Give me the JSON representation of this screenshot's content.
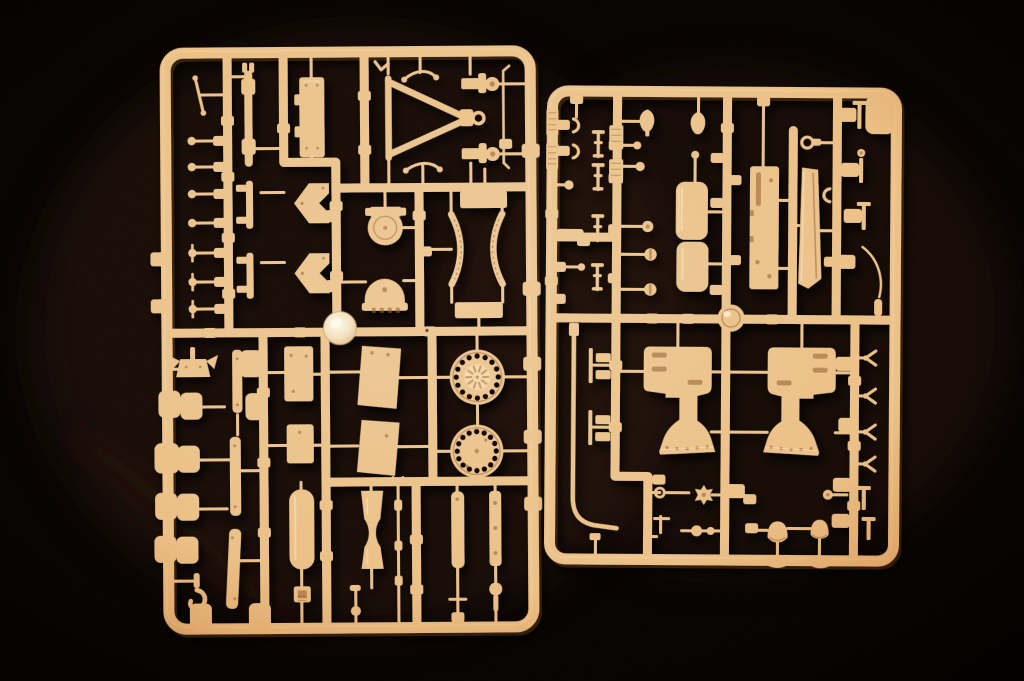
{
  "image": {
    "type": "photograph",
    "subject": "Two tan injection-molded plastic model-kit sprues (part frames) lying on a black background",
    "orientation": "landscape",
    "width_px": 1024,
    "height_px": 681
  },
  "colors": {
    "background": "#060302",
    "plastic": "#eecb98",
    "plastic_shadow": "#8a5526",
    "plastic_highlight": "#fdf0d6",
    "gate_blob_center": "#fffdf3",
    "gate_blob_edge": "#e3c493",
    "ambient_glow": "#2b190c",
    "vignette_orange": "#d8924e"
  },
  "sprues": [
    {
      "id": "left",
      "position": "left",
      "approx_bounds": {
        "x": 160,
        "y": 46,
        "w": 380,
        "h": 588
      },
      "notable_parts": [
        "column of seven small axle fittings",
        "thin tie rod",
        "coupling rod with sleeves",
        "two footed mounting bars",
        "equipment box with latches",
        "two chevron brackets",
        "round hatch with hinge tab",
        "dome cover with toothed flange",
        "towing A-frame with lunette ring",
        "two tie-rod linkages",
        "two capped stub-axle fittings",
        "long thin rod",
        "pair of curved serrated ribs",
        "two rectangular plates",
        "winged bracket",
        "ten rounded-square track pads",
        "tow hook",
        "three flat planks",
        "two riveted panels",
        "two trapezoidal fender panels",
        "smooth recoil cylinder",
        "waisted bobbin cylinder",
        "sectioned cleaning rod",
        "drilled road wheel with spoked hub",
        "drilled road wheel with plain face",
        "small cylinder and drilled flat bar",
        "buckle, crank, T-handle and pin details",
        "shiny injection-gate blob"
      ]
    },
    {
      "id": "right",
      "position": "right",
      "approx_bounds": {
        "x": 545,
        "y": 86,
        "w": 356,
        "h": 480
      },
      "notable_parts": [
        "blank corner label tab",
        "knurled rail patches",
        "pad-and-hook clamp pairs",
        "four jack-stand pins",
        "two teardrop grips",
        "ball-head and disc-head bolts",
        "two stacked seat cushions",
        "slotted mounting plate",
        "angled blade panel",
        "eyelet fitting",
        "round injection-gate boss",
        "bent fuel pipe with foot",
        "two mirrored carriage brackets with riveted bases",
        "star handwheel",
        "eye bolt",
        "ball linkage pin",
        "two bell cones",
        "four Y-fork fittings",
        "curved whip rod",
        "two oval gate pads"
      ]
    }
  ]
}
